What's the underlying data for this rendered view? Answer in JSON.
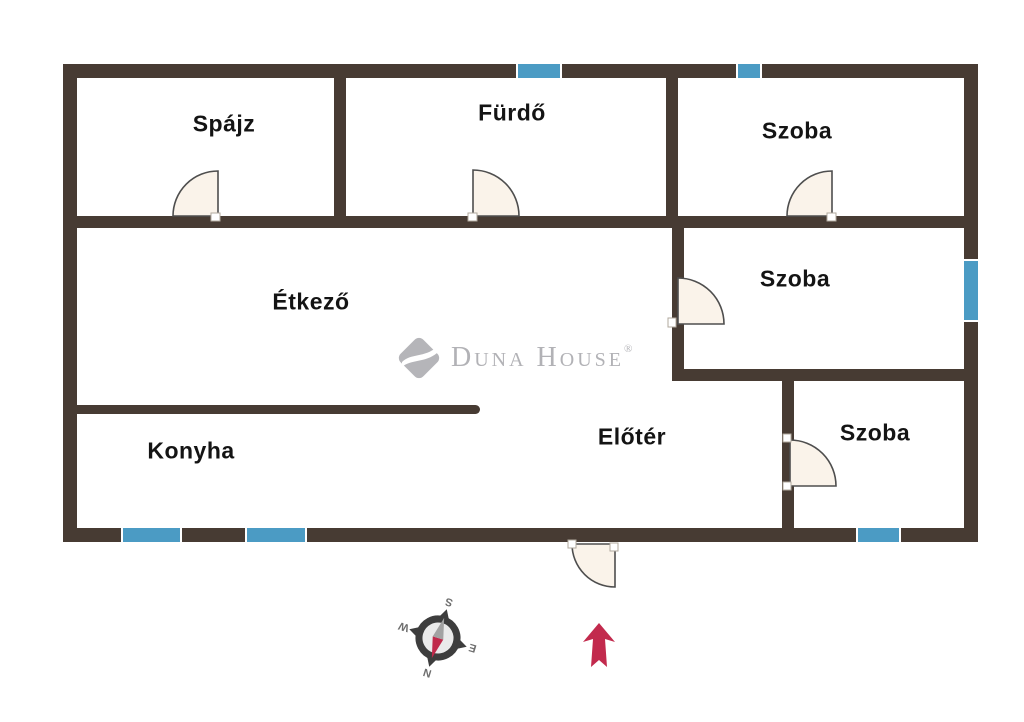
{
  "plan": {
    "rooms": {
      "spajz": "Spájz",
      "furdo": "Fürdő",
      "szoba_top_right": "Szoba",
      "szoba_middle_right": "Szoba",
      "szoba_bottom_right": "Szoba",
      "etkezo": "Étkező",
      "konyha": "Konyha",
      "eloter": "Előtér"
    }
  },
  "watermark": {
    "brand": "Duna House",
    "registered": "®"
  },
  "compass": {
    "north": "N",
    "south": "S",
    "east": "E",
    "west": "W"
  },
  "colors": {
    "wall": "#473b33",
    "window": "#4b9bc4",
    "door_fill": "#faf3ea",
    "door_stroke": "#4e4e4e",
    "north_arrow": "#c22a4d",
    "watermark_gray": "#b2b2b6",
    "compass_needle_red": "#c0294a",
    "compass_needle_gray": "#a2a2a2"
  }
}
